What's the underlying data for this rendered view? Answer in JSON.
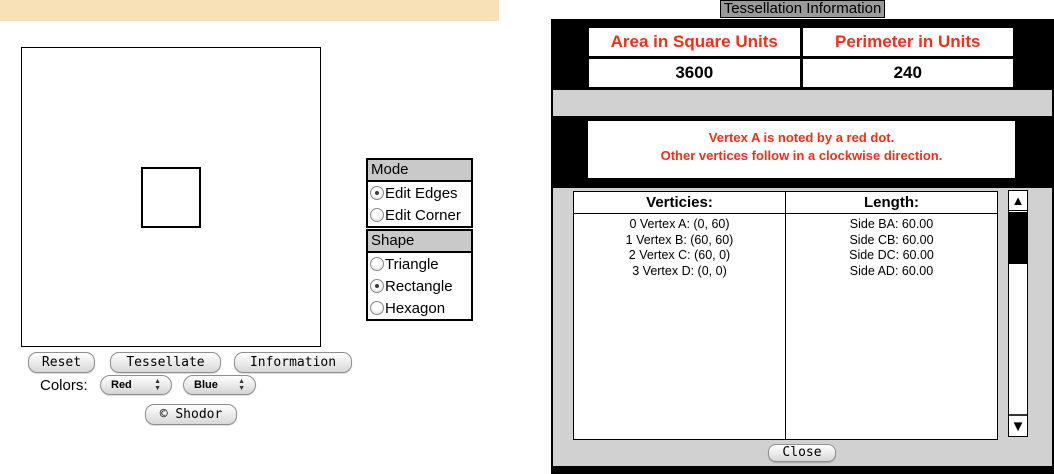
{
  "left_panel": {
    "mode_panel": {
      "title": "Mode",
      "options": [
        {
          "label": "Edit Edges",
          "selected": true
        },
        {
          "label": "Edit Corner",
          "selected": false
        }
      ]
    },
    "shape_panel": {
      "title": "Shape",
      "options": [
        {
          "label": "Triangle",
          "selected": false
        },
        {
          "label": "Rectangle",
          "selected": true
        },
        {
          "label": "Hexagon",
          "selected": false
        }
      ]
    },
    "buttons": {
      "reset": "Reset",
      "tessellate": "Tessellate",
      "information": "Information",
      "shodor": "© Shodor"
    },
    "colors_label": "Colors:",
    "color_selects": [
      {
        "value": "Red"
      },
      {
        "value": "Blue"
      }
    ]
  },
  "info_window": {
    "title": "Tessellation Information",
    "stats_table": {
      "area_header": "Area in Square Units",
      "perimeter_header": "Perimeter in Units",
      "area_value": "3600",
      "perimeter_value": "240"
    },
    "message": {
      "line1": "Vertex A is noted by a red dot.",
      "line2": "Other vertices follow in a clockwise direction."
    },
    "data_table": {
      "vertices_header": "Verticies:",
      "length_header": "Length:",
      "rows": [
        {
          "vertex": "0 Vertex A: (0, 60)",
          "length": "Side BA: 60.00"
        },
        {
          "vertex": "1 Vertex B: (60, 60)",
          "length": "Side CB: 60.00"
        },
        {
          "vertex": "2 Vertex C: (60, 0)",
          "length": "Side DC: 60.00"
        },
        {
          "vertex": "3 Vertex D: (0, 0)",
          "length": "Side AD: 60.00"
        }
      ]
    },
    "close_label": "Close"
  },
  "colors": {
    "accent_red": "#FB2D16",
    "tan_bar": "#F8E1B6",
    "panel_gray": "#C9C9C9",
    "window_gray": "#D1D1D1",
    "title_box_gray": "#9A9A9A"
  }
}
